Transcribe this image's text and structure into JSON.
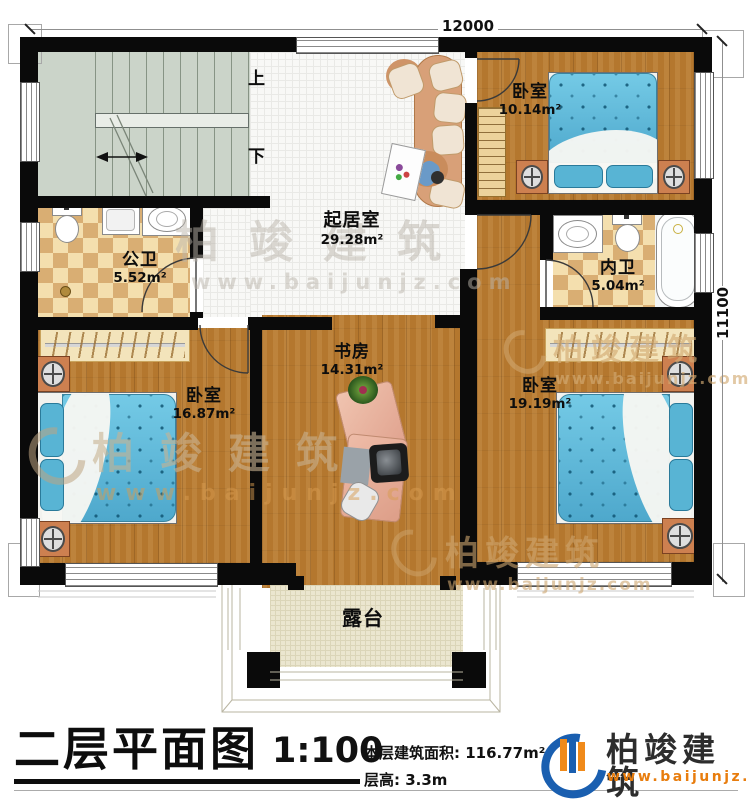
{
  "dimensions": {
    "top": "12000",
    "right": "11100"
  },
  "stairs": {
    "up_label": "上",
    "down_label": "下"
  },
  "rooms": {
    "bedroom_top": {
      "name": "卧室",
      "area": "10.14m²"
    },
    "living": {
      "name": "起居室",
      "area": "29.28m²"
    },
    "public_bath": {
      "name": "公卫",
      "area": "5.52m²"
    },
    "private_bath": {
      "name": "内卫",
      "area": "5.04m²"
    },
    "bedroom_left": {
      "name": "卧室",
      "area": "16.87m²"
    },
    "study": {
      "name": "书房",
      "area": "14.31m²"
    },
    "bedroom_right": {
      "name": "卧室",
      "area": "19.19m²"
    },
    "terrace": {
      "name": "露台"
    }
  },
  "titlebar": {
    "title": "二层平面图",
    "scale": "1:100",
    "floor_area_label": "本层建筑面积:",
    "floor_area_value": "116.77m²",
    "floor_height_label": "层高:",
    "floor_height_value": "3.3m"
  },
  "brand": {
    "name": "柏竣建筑",
    "url": "www.baijunjz.com"
  },
  "watermark": {
    "name": "柏竣建筑",
    "url": "www.baijunjz.com"
  },
  "colors": {
    "wall": "#0a0a0a",
    "wood": "#b4772e",
    "tile": "#f8f8f6",
    "checker_light": "#f4dfae",
    "checker_dark": "#d9ae73",
    "bed_blue": "#64bedd",
    "stair_green": "#cbd4c9",
    "terrace_beige": "#ebe6cf",
    "brand_blue": "#1a5fb0",
    "brand_orange": "#e87d0e"
  }
}
